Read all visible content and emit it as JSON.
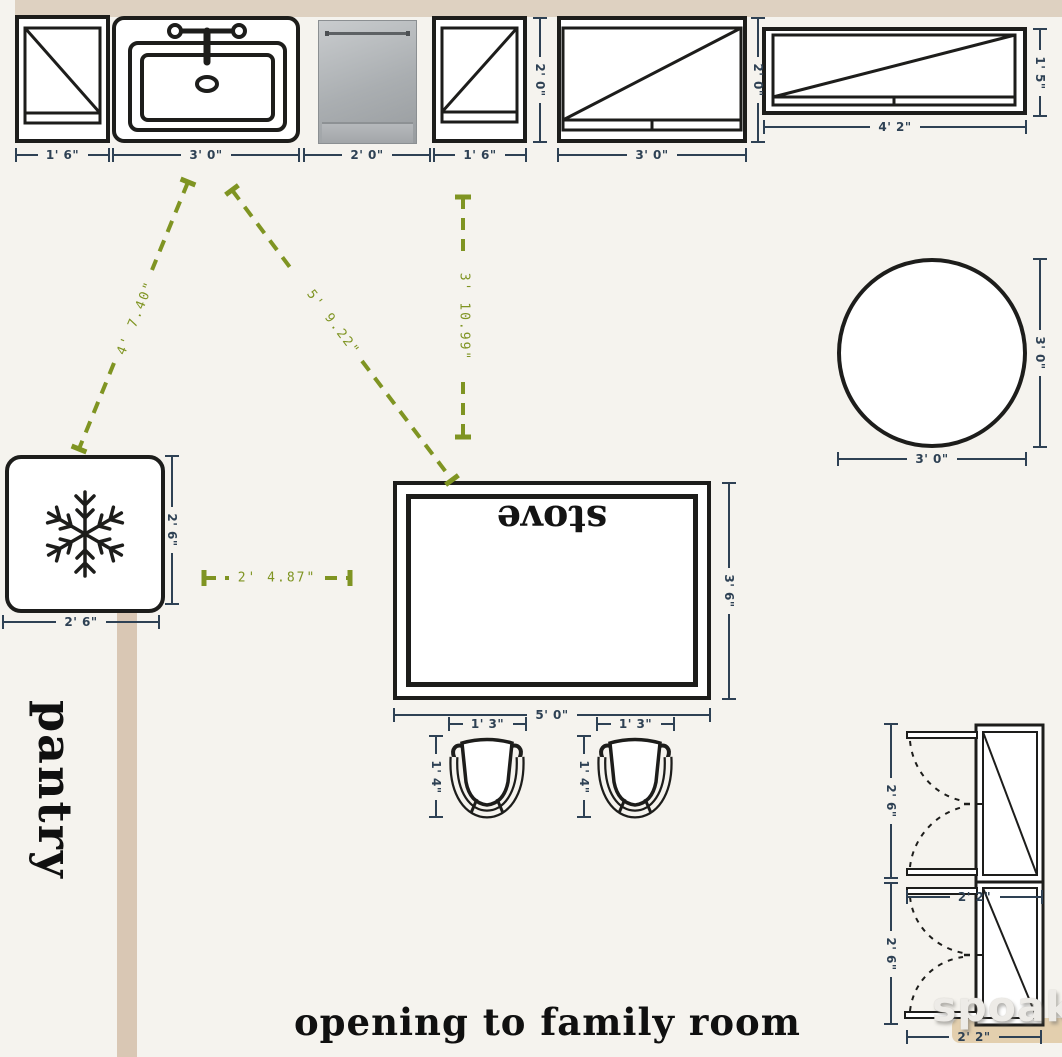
{
  "palette": {
    "bg": "#f5f3ee",
    "ink": "#1d1d1b",
    "dim": "#2e4154",
    "guide": "#7f9422",
    "wall_top": "#ded1c1",
    "wall_pantry": "#d9c7b4",
    "wall_family": "#e3cfae",
    "appliance_steel": "#aaaeb1"
  },
  "top_row": {
    "cabinet_small_left": {
      "width": "1' 6\""
    },
    "sink": {
      "width": "3' 0\""
    },
    "dishwasher": {
      "width": "2' 0\""
    },
    "cabinet_small_right": {
      "width": "1' 6\"",
      "height": "2' 0\""
    },
    "window_mid": {
      "width": "3' 0\"",
      "height": "2' 0\""
    },
    "window_right": {
      "width": "4' 2\"",
      "height": "1' 5\""
    }
  },
  "guides": {
    "fridge_to_sink": "4' 7.40\"",
    "sink_to_stove": "5' 9.22\"",
    "window_to_stove": "3' 10.99\"",
    "fridge_to_stove": "2' 4.87\""
  },
  "fridge": {
    "width": "2' 6\"",
    "height": "2' 6\""
  },
  "stove": {
    "label": "stove",
    "width": "5' 0\"",
    "height": "3' 6\""
  },
  "stools": {
    "left": {
      "width": "1' 3\"",
      "height": "1' 4\""
    },
    "right": {
      "width": "1' 3\"",
      "height": "1' 4\""
    }
  },
  "table": {
    "width": "3' 0\"",
    "height": "3' 0\""
  },
  "pantry_cabinets": {
    "upper": {
      "width": "2' 2\"",
      "height": "2' 6\""
    },
    "lower": {
      "width": "2' 2\"",
      "height": "2' 6\""
    }
  },
  "texts": {
    "pantry": "pantry",
    "opening": "opening to family room"
  },
  "watermark": "spoak."
}
